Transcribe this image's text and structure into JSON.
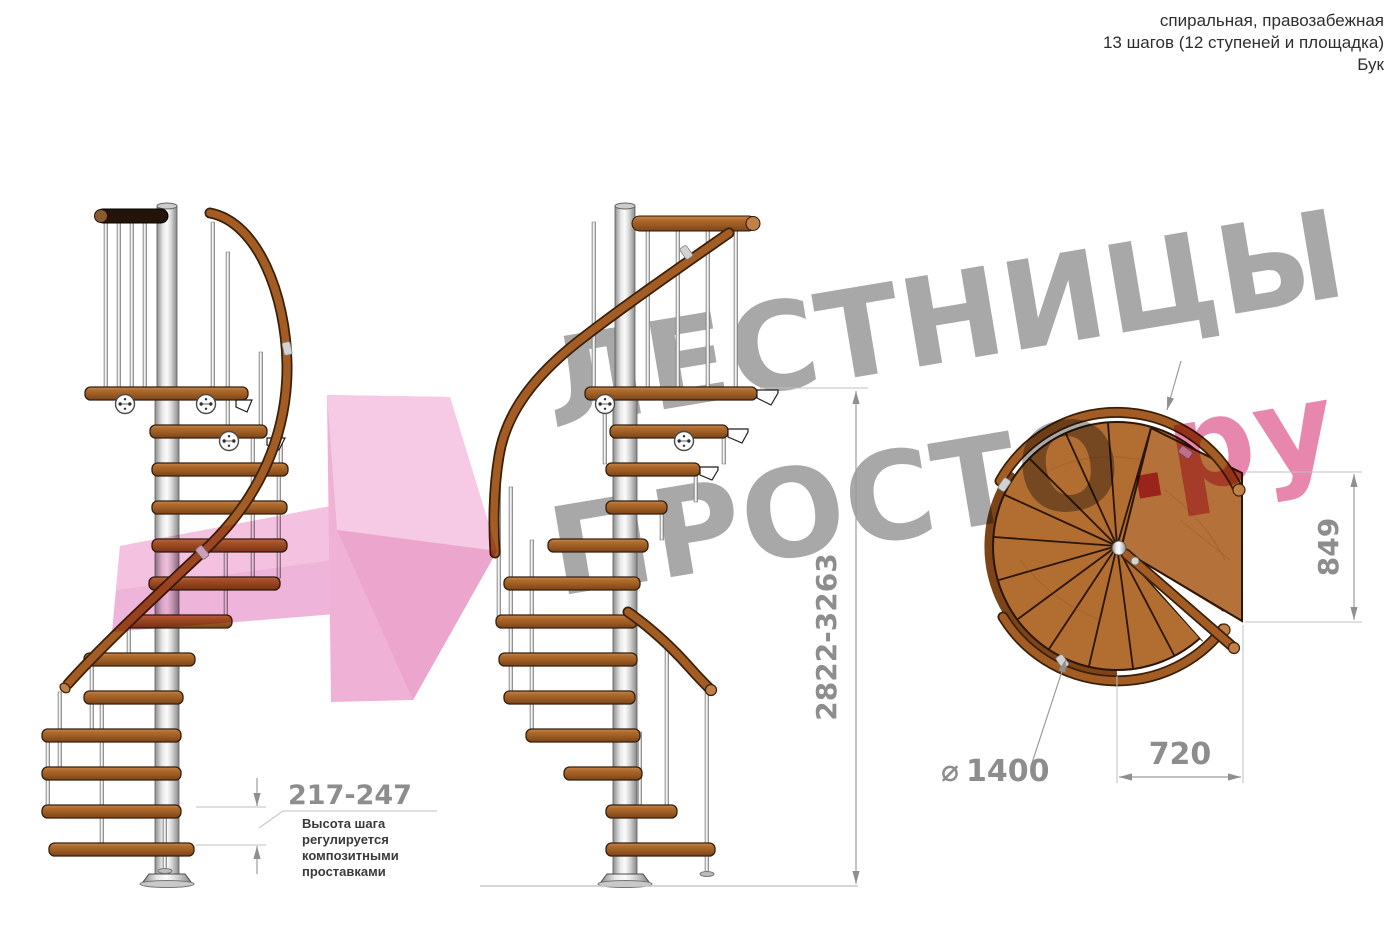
{
  "header": {
    "spec": "спиральная, правозабежная",
    "steps": "13 шагов (12 ступеней и площадка)",
    "material": "Бук"
  },
  "watermark": {
    "line1": "ЛЕСТНИЦЫ",
    "line2_gray": "ПРОСТО",
    "line2_dot": ".",
    "line2_suffix": "ру"
  },
  "dimensions": {
    "total_height": "2822-3263",
    "step_height": "217-247",
    "platform_side": "849",
    "exit_width": "720",
    "diameter_sign": "⌀",
    "diameter_value": "1400"
  },
  "annotation": {
    "line1": "Высота шага",
    "line2": "регулируется",
    "line3": "композитными",
    "line4": "проставками"
  },
  "palette": {
    "wood": "#a9642a",
    "handrail": "#a25c24",
    "metal_pole": "#d6d6d6",
    "watermark_gray": "#a8a8a8",
    "watermark_pink": "#e4699a",
    "dimension_gray": "#8d8d8d"
  }
}
